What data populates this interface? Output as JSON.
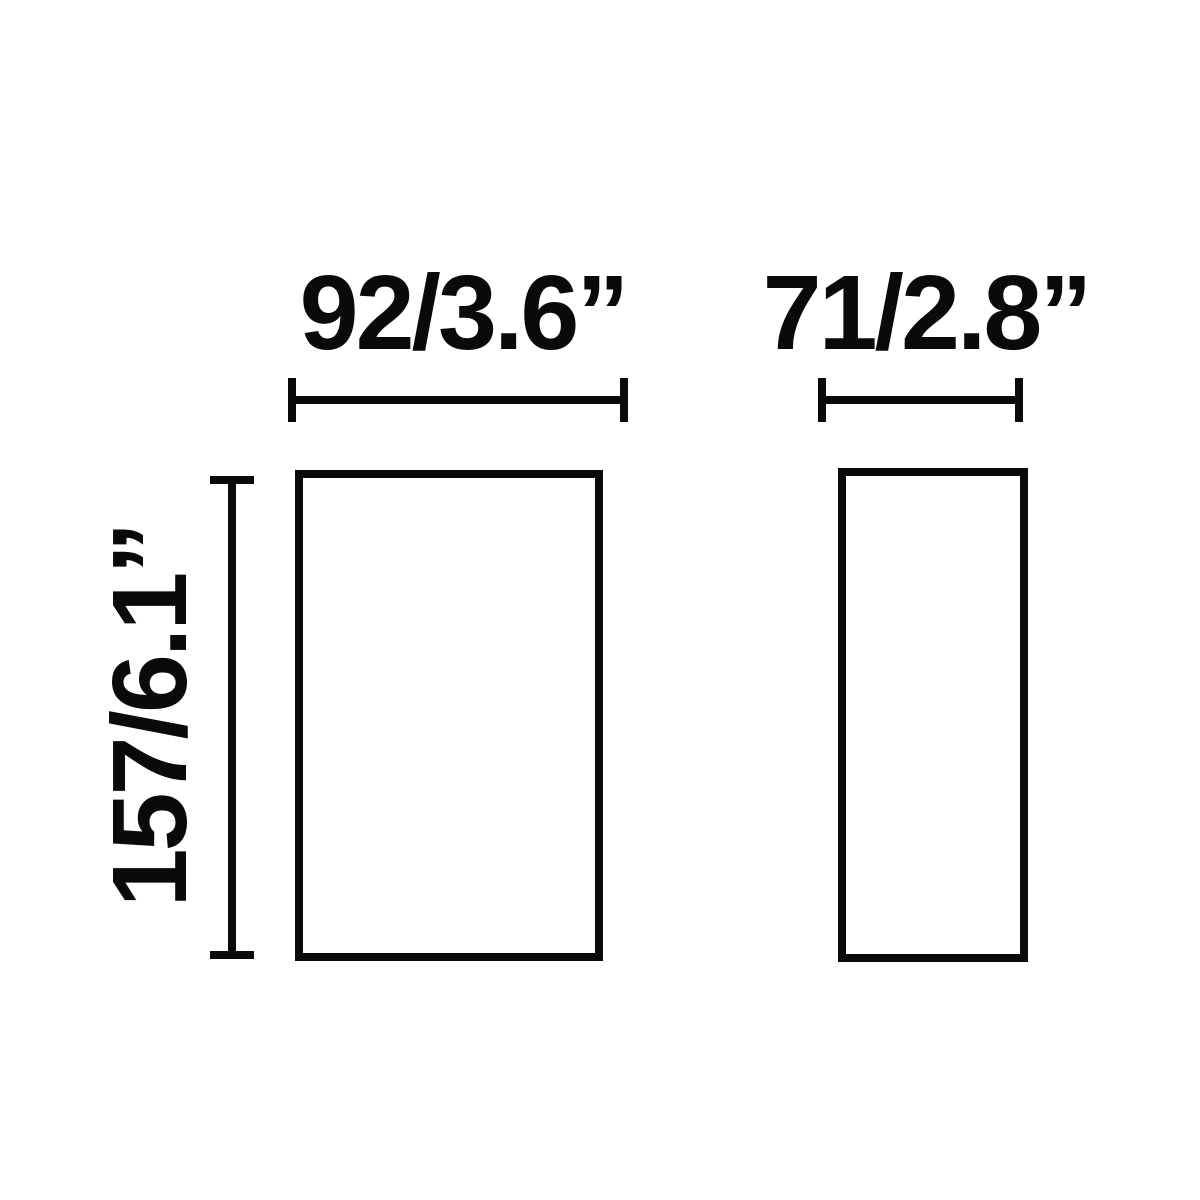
{
  "diagram": {
    "front_view": {
      "width_label": "92/3.6”",
      "height_label": "157/6.1”"
    },
    "side_view": {
      "width_label": "71/2.8”"
    },
    "colors": {
      "line": "#0a0a0a",
      "background": "#ffffff"
    }
  }
}
